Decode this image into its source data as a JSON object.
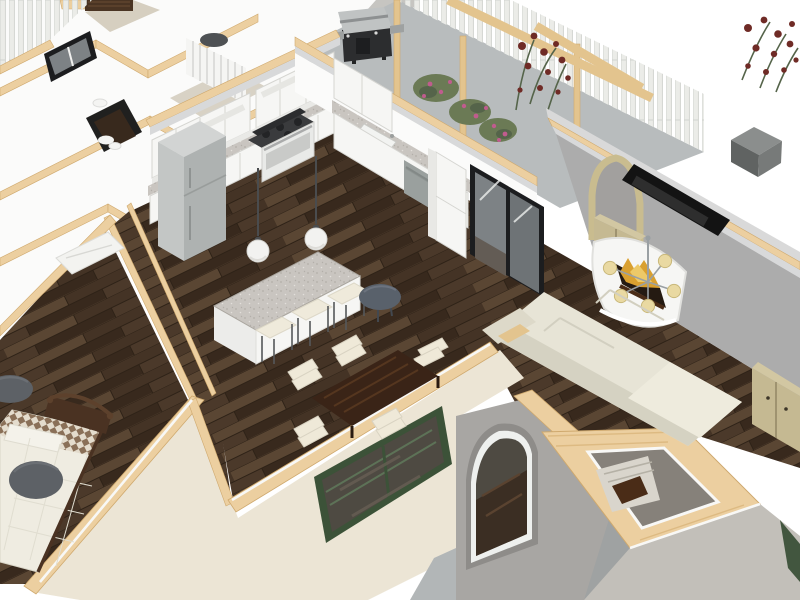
{
  "viewport": {
    "kind": "3d-home-design-render",
    "view_mode": "overhead dollhouse cutaway",
    "width": 800,
    "height": 600,
    "background": "#ffffff"
  },
  "labels": {
    "viewport": "3D dollhouse view of single-story home",
    "balcony": "Balcony terrace with picket fence, pergola beams, BBQ grill and rose bushes",
    "kitchen": "Kitchen with white shaker cabinets, granite counters, island and bar stools",
    "dining": "Dining area with dark wood table and cream chairs",
    "living": "Living room with sectional sofa, wall TV, fireplace and chandelier",
    "bedroom": "Bedroom with bed, patterned quilt and gray ottoman poufs",
    "hallway": "Hallway with dark wood flooring and ceiling lights",
    "stairwell": "Open stairwell shaft with staircase",
    "exterior": "Cream stucco exterior with green casement window, arched window and patio"
  },
  "scene": {
    "areas": [
      {
        "name": "balcony-terrace",
        "objects": [
          "concrete-deck",
          "picket-fence",
          "pergola-posts",
          "pergola-beams",
          "bbq-grill",
          "rose-bushes",
          "climbing-roses"
        ],
        "counts": {
          "pergola_posts": 3,
          "rose_bushes": 3
        }
      },
      {
        "name": "kitchen",
        "objects": [
          "upper-cabinets",
          "base-cabinets",
          "granite-countertop",
          "refrigerator",
          "gas-range",
          "dishwasher",
          "kitchen-sink",
          "tall-pantry-cabinet",
          "kitchen-island",
          "bar-stools",
          "pendant-lights",
          "bistro-table",
          "sliding-glass-door"
        ],
        "counts": {
          "bar_stools": 3,
          "pendant_lights": 2
        }
      },
      {
        "name": "dining-area",
        "objects": [
          "dining-table",
          "dining-chairs"
        ],
        "counts": {
          "dining_chairs": 5
        }
      },
      {
        "name": "living-room",
        "objects": [
          "sectional-sofa",
          "chaise-cushion",
          "wall-mounted-tv",
          "curved-fireplace",
          "fire-flames",
          "chandelier",
          "arched-niche",
          "niche-cabinet",
          "tan-sideboard"
        ]
      },
      {
        "name": "bedroom",
        "objects": [
          "bed",
          "dark-wood-headboard",
          "pillow",
          "patterned-quilt",
          "waffle-blanket",
          "ottoman-poufs",
          "white-dresser"
        ],
        "counts": {
          "ottoman_poufs": 2
        }
      },
      {
        "name": "hallway",
        "objects": [
          "wood-floor",
          "ceiling-lights",
          "stair-opening-to-lower-floor"
        ]
      },
      {
        "name": "stairwell",
        "objects": [
          "stair-shaft",
          "staircase",
          "railing-caps"
        ]
      },
      {
        "name": "exterior",
        "objects": [
          "gray-stucco-wall",
          "cream-stucco-wall",
          "green-casement-window",
          "arched-window",
          "patio-slab",
          "chimney-cube",
          "lawn-strip",
          "black-framed-window",
          "cut-wall-wood-tops"
        ]
      }
    ]
  },
  "colors": {
    "bg": "#ffffff",
    "wood_base": "#4b392a",
    "wood_light": "#5a4633",
    "wood_mid": "#443325",
    "wood_dark": "#38291d",
    "wood_line": "#2e2217",
    "wall_white": "#fbfbfa",
    "wall_shadow": "#e9e9e6",
    "crown_gray": "#d8d9da",
    "trim_white": "#f8f8f6",
    "cap_wood": "#eccfa0",
    "cap_grain": "#ddba82",
    "cap_edge": "#cfa96e",
    "stucco_cream": "#ece5d5",
    "stucco_gray": "#c6c5c1",
    "accent_gray": "#acacac",
    "arch_wall_gray": "#a8a6a3",
    "concrete": "#b8bcbd",
    "patio": "#b2b6b7",
    "fence_white": "#ebece8",
    "fence_edge": "#cfd1cd",
    "pergola_wood": "#e3c48e",
    "rose_green": "#6b7a55",
    "rose_green_dark": "#55644a",
    "rose_pink": "#c05c8e",
    "rose_red": "#6f2b26",
    "grill_black": "#2c2d2f",
    "grill_steel": "#c0c3c3",
    "cabinet_white": "#f6f6f4",
    "cabinet_line": "#d5d5d1",
    "granite": "#c9c5c0",
    "granite_dot1": "#b3afa9",
    "granite_dot2": "#e2dfda",
    "fridge_gray": "#aeb2b1",
    "fridge_side": "#c3c6c5",
    "fridge_top": "#d2d4d3",
    "cooktop_dark": "#3a3b3d",
    "dishwasher_gray": "#9aa09e",
    "stool_cream": "#efeadb",
    "stool_leg": "#55585a",
    "pendant_white": "#f2f2f0",
    "pendant_stem": "#4a4c4e",
    "round_table_dark": "#59616b",
    "dining_wood": "#3a2417",
    "dining_wood_streak": "#55361f",
    "chair_cream": "#efe9d8",
    "tv_black": "#131313",
    "fireplace_white": "#f6f6f4",
    "flame_gold": "#d9a030",
    "flame_light": "#edc968",
    "log_brown": "#4a2c17",
    "shade_cream": "#e9d9a2",
    "shade_rim": "#c9b87a",
    "metal_gray": "#9aa0a3",
    "niche_tan": "#c9bc8f",
    "cab_tan": "#c5b992",
    "cab_tan_top": "#d2c7a2",
    "cab_tan_dark": "#8f8361",
    "sofa_cream": "#e7e4d6",
    "sofa_shadow": "#d5d2c2",
    "glass_gray": "#7d8285",
    "frame_black": "#1c1d1f",
    "window_green": "#3c5238",
    "glass_dark": "#4e4a42",
    "bed_white": "#efece1",
    "quilt_brown": "#8a7058",
    "quilt_cream": "#e4dccd",
    "bed_wood": "#4a3222",
    "pouf_gray": "#5d6166",
    "pouf_hi": "#6b6f74",
    "stair_shaft": "#86817a",
    "stair_light": "#d9d5cc",
    "fixture_dark": "#4e5154",
    "taupe_floor": "#d8d2c5",
    "beige_floor": "#d6cfc0",
    "lawn_green": "#42563f",
    "gray_lower": "#9fa2a2",
    "gray_below": "#c2bfb9"
  }
}
